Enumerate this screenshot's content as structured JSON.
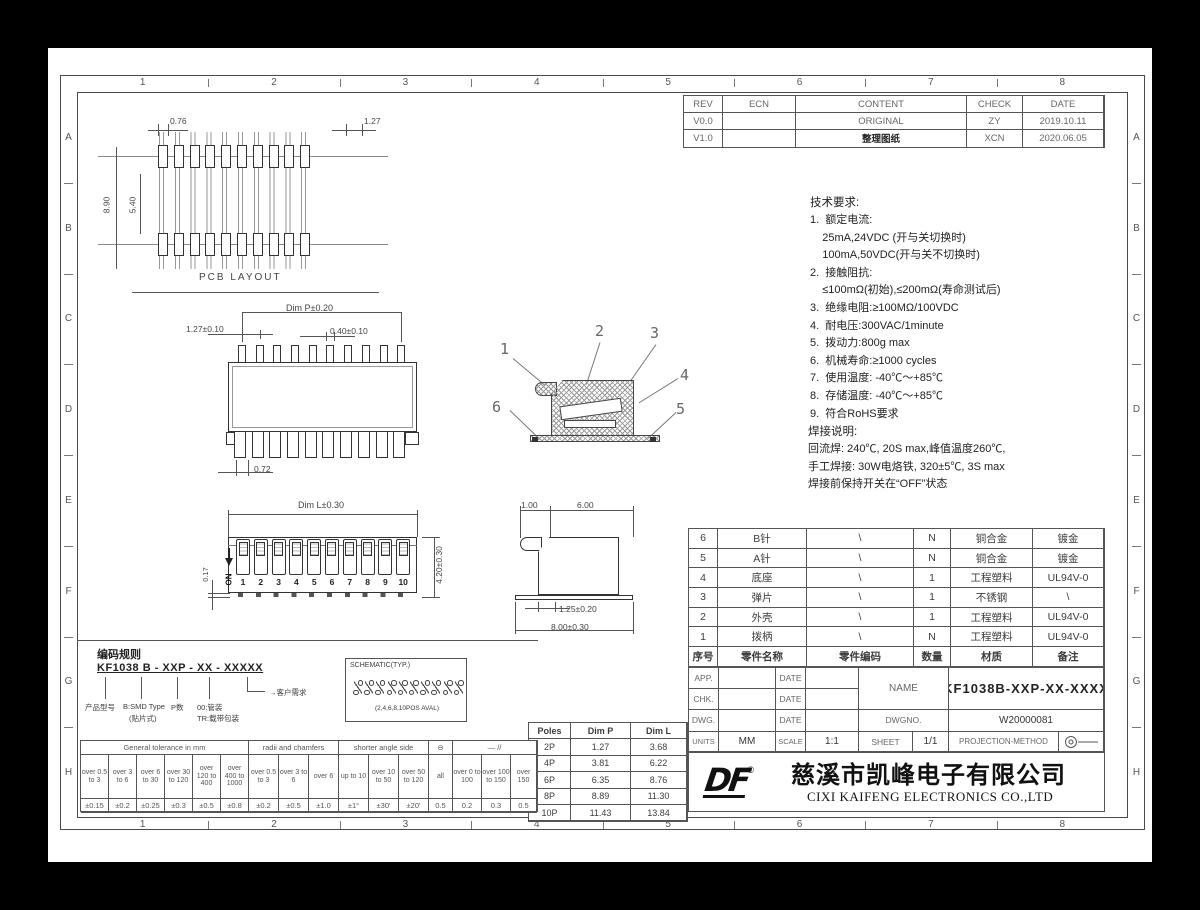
{
  "frame": {
    "cols": [
      "1",
      "2",
      "3",
      "4",
      "5",
      "6",
      "7",
      "8"
    ],
    "rows": [
      "A",
      "B",
      "C",
      "D",
      "E",
      "F",
      "G",
      "H"
    ]
  },
  "revision": {
    "headers": [
      "REV",
      "ECN",
      "CONTENT",
      "CHECK",
      "DATE"
    ],
    "rows": [
      {
        "rev": "V0.0",
        "ecn": "",
        "content": "ORIGINAL",
        "check": "ZY",
        "date": "2019.10.11"
      },
      {
        "rev": "V1.0",
        "ecn": "",
        "content": "整理图纸",
        "check": "XCN",
        "date": "2020.06.05"
      }
    ]
  },
  "tech": {
    "title": "技术要求:",
    "lines": [
      "1.  额定电流:",
      "    25mA,24VDC (开与关切换时)",
      "    100mA,50VDC(开与关不切换时)",
      "2.  接触阻抗:",
      "    ≤100mΩ(初始),≤200mΩ(寿命测试后)",
      "3.  绝缘电阻:≥100MΩ/100VDC",
      "4.  耐电压:300VAC/1minute",
      "5.  拨动力:800g max",
      "6.  机械寿命:≥1000 cycles",
      "7.  使用温度: -40℃～+85℃",
      "8.  存储温度: -40℃～+85℃",
      "9.  符合RoHS要求"
    ]
  },
  "solder": {
    "title": "焊接说明:",
    "lines": [
      "回流焊: 240℃, 20S max,峰值温度260℃,",
      "手工焊接: 30W电烙铁, 320±5℃, 3S max",
      "焊接前保持开关在“OFF”状态"
    ]
  },
  "bom": {
    "headers": [
      "序号",
      "零件名称",
      "零件编码",
      "数量",
      "材质",
      "备注"
    ],
    "rows": [
      [
        "6",
        "B针",
        "\\",
        "N",
        "铜合金",
        "镀金"
      ],
      [
        "5",
        "A针",
        "\\",
        "N",
        "铜合金",
        "镀金"
      ],
      [
        "4",
        "底座",
        "\\",
        "1",
        "工程塑料",
        "UL94V-0"
      ],
      [
        "3",
        "弹片",
        "\\",
        "1",
        "不锈钢",
        "\\"
      ],
      [
        "2",
        "外壳",
        "\\",
        "1",
        "工程塑料",
        "UL94V-0"
      ],
      [
        "1",
        "拨柄",
        "\\",
        "N",
        "工程塑料",
        "UL94V-0"
      ]
    ]
  },
  "titleblock": {
    "app_label": "APP.",
    "chk_label": "CHK.",
    "dwg_label": "DWG.",
    "date_label": "DATE",
    "name_label": "NAME",
    "name_value": "KF1038B-XXP-XX-XXXX",
    "dwgno_label": "DWGNO.",
    "dwgno_value": "W20000081",
    "units_label": "UNITS",
    "units_value": "MM",
    "scale_label": "SCALE",
    "scale_value": "1:1",
    "sheet_label": "SHEET",
    "sheet_value": "1/1",
    "projection_label": "PROJECTION-METHOD"
  },
  "company": {
    "logo": "DF",
    "reg": "®",
    "cn": "慈溪市凯峰电子有限公司",
    "en": "CIXI KAIFENG ELECTRONICS CO.,LTD"
  },
  "poles": {
    "headers": [
      "Poles",
      "Dim P",
      "Dim L"
    ],
    "rows": [
      [
        "2P",
        "1.27",
        "3.68"
      ],
      [
        "4P",
        "3.81",
        "6.22"
      ],
      [
        "6P",
        "6.35",
        "8.76"
      ],
      [
        "8P",
        "8.89",
        "11.30"
      ],
      [
        "10P",
        "11.43",
        "13.84"
      ]
    ]
  },
  "tolerance": {
    "groups": [
      {
        "label": "General tolerance in mm"
      },
      {
        "label": "radii and chamfers"
      },
      {
        "label": "shorter angle side"
      },
      {
        "label": "⊖"
      },
      {
        "label": "—  //"
      }
    ],
    "cols": [
      {
        "range": "over 0.5 to 3",
        "val": "±0.15"
      },
      {
        "range": "over 3 to 6",
        "val": "±0.2"
      },
      {
        "range": "over 6 to 30",
        "val": "±0.25"
      },
      {
        "range": "over 30 to 120",
        "val": "±0.3"
      },
      {
        "range": "over 120 to 400",
        "val": "±0.5"
      },
      {
        "range": "over 400 to 1000",
        "val": "±0.8"
      },
      {
        "range": "over 0.5 to 3",
        "val": "±0.2"
      },
      {
        "range": "over 3 to 6",
        "val": "±0.5"
      },
      {
        "range": "over 6",
        "val": "±1.0"
      },
      {
        "range": "up to 10",
        "val": "±1°"
      },
      {
        "range": "over 10 to 50",
        "val": "±30'"
      },
      {
        "range": "over 50 to 120",
        "val": "±20'"
      },
      {
        "range": "all",
        "val": "0.5"
      },
      {
        "range": "over 0 to 100",
        "val": "0.2"
      },
      {
        "range": "over 100 to 150",
        "val": "0.3"
      },
      {
        "range": "over 150",
        "val": "0.5"
      }
    ]
  },
  "coding": {
    "title": "编码规则",
    "code": "KF1038 B - XXP - XX - XXXXX",
    "label_product": "产品型号",
    "label_type": "B:SMD Type",
    "label_type2": "(贴片式)",
    "label_poles": "P数",
    "label_pack1": "00:管装",
    "label_pack2": "TR:载带包装",
    "label_customer": "客户需求"
  },
  "schematic": {
    "title": "SCHEMATIC(TYP.)",
    "caption": "(2,4,6,8,10POS AVAL)"
  },
  "views": {
    "pcb": {
      "label": "PCB LAYOUT",
      "dim_pad": "0.76",
      "dim_pitch": "1.27",
      "dim_outer": "8.90",
      "dim_inner": "5.40"
    },
    "top": {
      "dim_p": "Dim P±0.20",
      "dim_pitch": "1.27±0.10",
      "dim_pin": "0.40±0.10",
      "dim_foot": "0.72"
    },
    "front": {
      "dim_l": "Dim L±0.30",
      "dim_h": "4.20±0.30",
      "dim_standoff": "0.17",
      "on_label": "ON",
      "positions": [
        "1",
        "2",
        "3",
        "4",
        "5",
        "6",
        "7",
        "8",
        "9",
        "10"
      ]
    },
    "side": {
      "dim_tab": "1.00",
      "dim_body": "6.00",
      "dim_foot": "1.25±0.20",
      "dim_total": "8.00±0.30"
    },
    "section": {
      "callouts": [
        "1",
        "2",
        "3",
        "4",
        "5",
        "6"
      ]
    }
  }
}
